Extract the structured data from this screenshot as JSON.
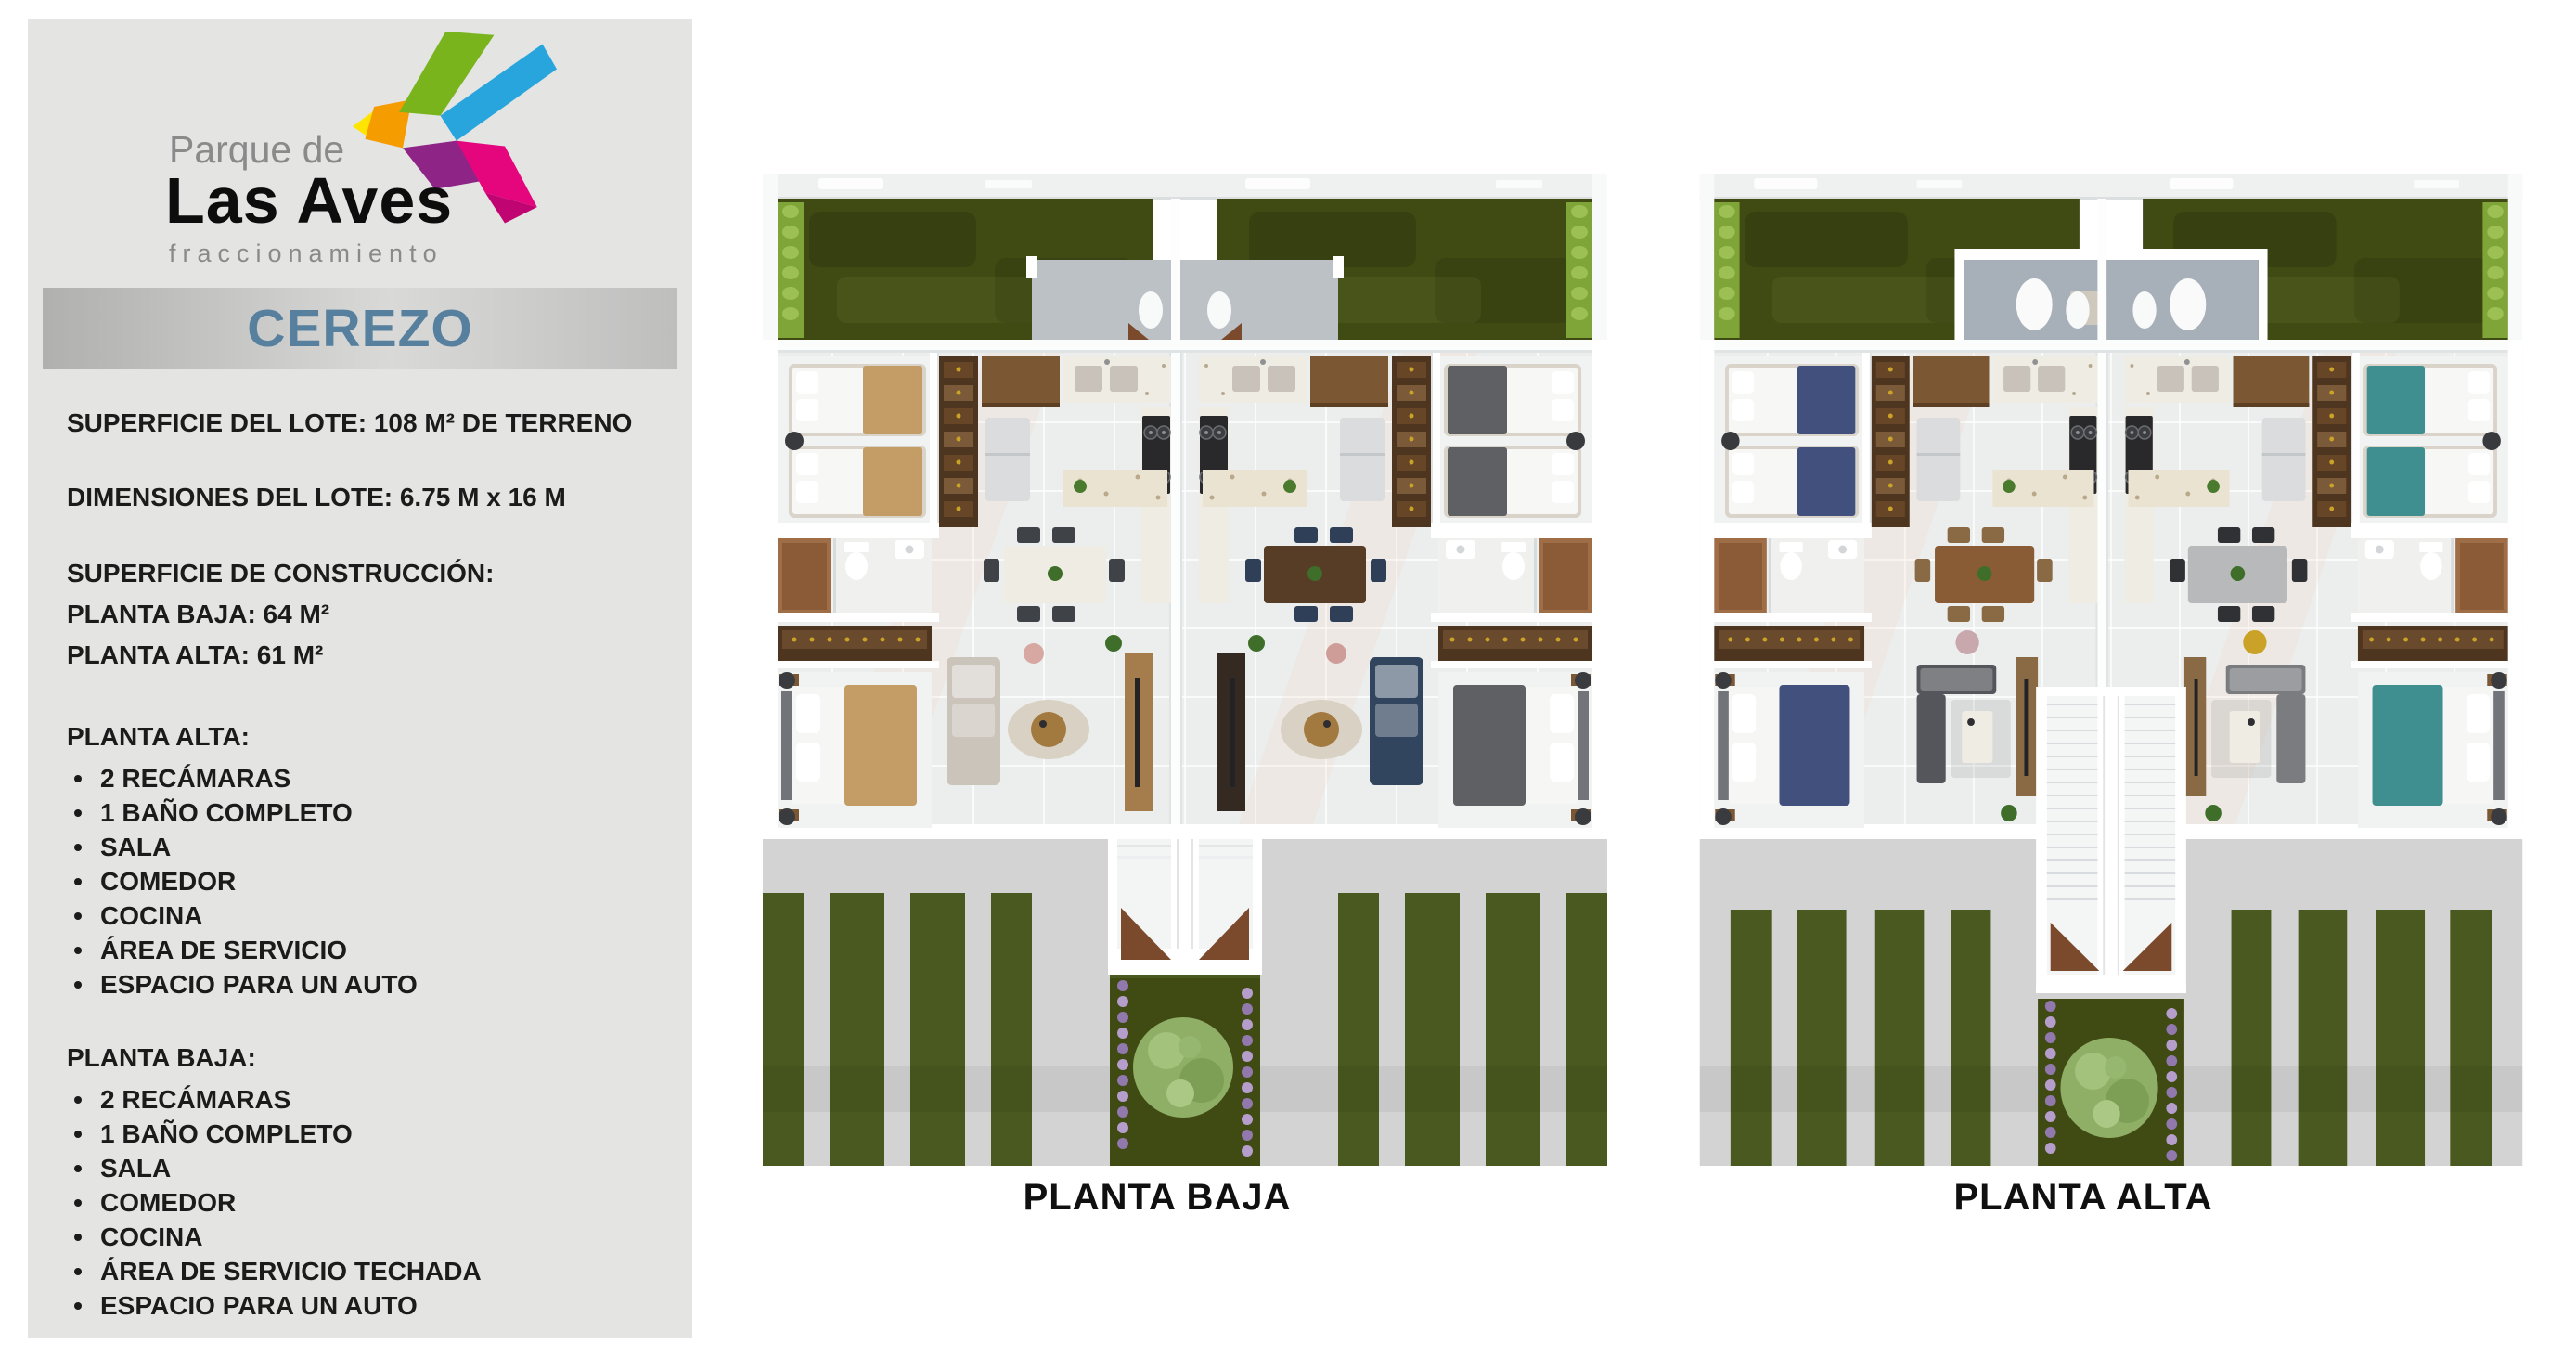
{
  "brand": {
    "name_top": "Parque de",
    "name_main": "Las Aves",
    "name_sub": "fraccionamiento",
    "bird_colors": {
      "green": "#7ab41d",
      "blue": "#29a5de",
      "orange": "#f59c00",
      "yellow": "#ffe400",
      "magenta": "#e5067e",
      "purple": "#8e2486",
      "dark_pink": "#c00572"
    }
  },
  "sidebar": {
    "model_name": "CEREZO",
    "lot_surface": "SUPERFICIE DEL LOTE: 108 M² DE TERRENO",
    "lot_dimensions": "DIMENSIONES DEL LOTE: 6.75 M x 16 M",
    "construction_heading": "SUPERFICIE DE CONSTRUCCIÓN:",
    "construction_planta_baja": "PLANTA BAJA: 64 M²",
    "construction_planta_alta": "PLANTA ALTA: 61 M²",
    "planta_alta_heading": "PLANTA ALTA:",
    "planta_alta_items": [
      "2 RECÁMARAS",
      "1 BAÑO COMPLETO",
      "SALA",
      "COMEDOR",
      "COCINA",
      "ÁREA DE SERVICIO",
      "ESPACIO PARA UN AUTO"
    ],
    "planta_baja_heading": "PLANTA BAJA:",
    "planta_baja_items": [
      "2 RECÁMARAS",
      "1 BAÑO COMPLETO",
      "SALA",
      "COMEDOR",
      "COCINA",
      "ÁREA DE SERVICIO TECHADA",
      "ESPACIO PARA UN AUTO"
    ]
  },
  "plans": {
    "baja": {
      "label": "PLANTA BAJA",
      "center_feature": "entry",
      "left_unit": {
        "bed": "#c49d66",
        "table": "#efece4",
        "chair": "#3f4247",
        "sofa": "#cbc4ba",
        "accent": "#d7a8a2",
        "console": "#a57c4b"
      },
      "right_unit": {
        "bed": "#5e6064",
        "table": "#573d26",
        "chair": "#2e3f57",
        "sofa": "#32455f",
        "accent": "#cf9d98",
        "console": "#352a22"
      }
    },
    "alta": {
      "label": "PLANTA ALTA",
      "center_feature": "stairs",
      "left_unit": {
        "bed": "#42507e",
        "table": "#8a5c36",
        "chair": "#8a6a45",
        "sofa": "#54565b",
        "accent": "#c8a7ad",
        "console": "#8a6a45"
      },
      "right_unit": {
        "bed": "#3f8e90",
        "table": "#b7b9ba",
        "chair": "#2f3134",
        "sofa": "#7b7c80",
        "accent": "#c9a227",
        "console": "#8a6a45"
      }
    }
  },
  "palette": {
    "page_bg": "#ffffff",
    "sidebar_bg": "#e4e4e3",
    "banner_text": "#56809e",
    "body_text": "#1b1b1b",
    "logo_gray": "#8a8a8a",
    "garden": "#3f4b13",
    "leaf": "#7fa437",
    "patio": "#bcc1c5",
    "terrace": "#a7afb8",
    "lawn": "#49591f",
    "concrete": "#d2d3d2",
    "floor": "#ebeeed",
    "marble": "#efece3",
    "wood": "#7b5833",
    "dark_wood": "#4e351f",
    "stair": "#f4f5f5",
    "wedge": "#7b4a2d",
    "tree": "#8fae66",
    "lavender": "#b29aca"
  }
}
